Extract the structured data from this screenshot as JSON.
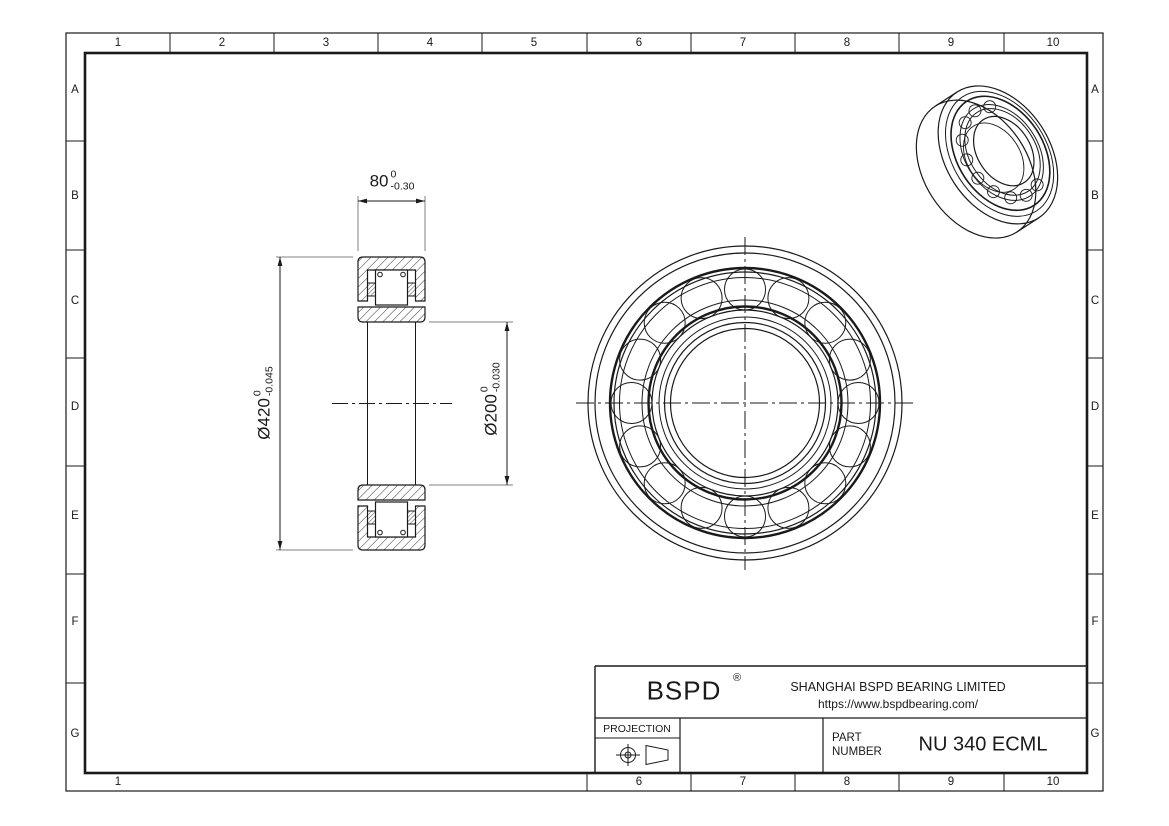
{
  "drawing": {
    "brand": "BSPD",
    "registered_mark": "®",
    "company": "SHANGHAI BSPD BEARING LIMITED",
    "website": "https://www.bspdbearing.com/",
    "projection_label": "PROJECTION",
    "part_label_line1": "PART",
    "part_label_line2": "NUMBER",
    "part_number": "NU 340 ECML"
  },
  "grid": {
    "columns": [
      "1",
      "2",
      "3",
      "4",
      "5",
      "6",
      "7",
      "8",
      "9",
      "10"
    ],
    "rows": [
      "A",
      "B",
      "C",
      "D",
      "E",
      "F",
      "G"
    ],
    "bottom_columns": [
      "1",
      "6",
      "7",
      "8",
      "9",
      "10"
    ]
  },
  "dimensions": {
    "width": {
      "value": "80",
      "tol_upper": "0",
      "tol_lower": "-0.30"
    },
    "outer_diameter": {
      "value": "Ø420",
      "tol_upper": "0",
      "tol_lower": "-0.045"
    },
    "bore_diameter": {
      "value": "Ø200",
      "tol_upper": "0",
      "tol_lower": "-0.030"
    }
  },
  "colors": {
    "line": "#1a1a1a",
    "extension_line": "#808080",
    "background": "#ffffff"
  }
}
